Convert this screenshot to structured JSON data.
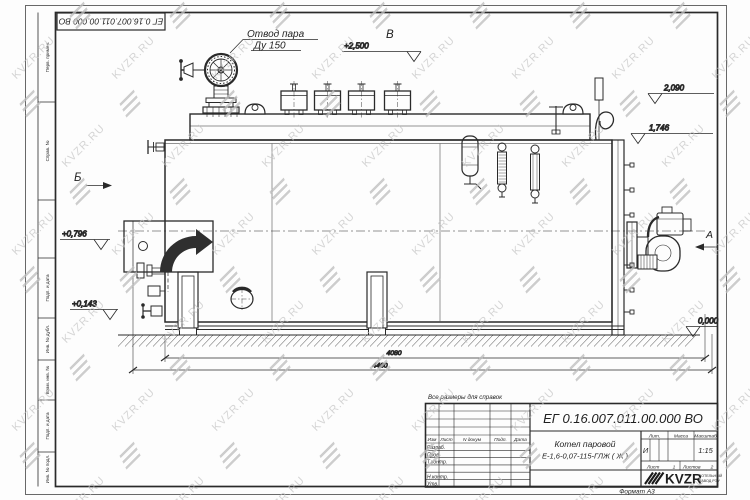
{
  "watermark": {
    "text": "KVZR.RU"
  },
  "margins": [
    "Перв. примен.",
    "Справ. №",
    "Подп. и дата",
    "Инв. № дубл.",
    "Взам. инв. №",
    "Подп. и дата",
    "Инв. № подл."
  ],
  "drawing": {
    "stamp": "ЕГ 0.16.007.011.00.000  ВО",
    "callout1": "Отвод пара",
    "callout2": "Ду 150",
    "views": {
      "b": "Б",
      "v": "В",
      "a": "А"
    },
    "elev": {
      "e1": "+2,500",
      "e2": "2,090",
      "e3": "1,746",
      "e4": "+0,796",
      "e5": "+0,143",
      "e6": "0,000"
    },
    "dims": {
      "d1": "4080",
      "d2": "4460"
    }
  },
  "title_block": {
    "note": "Все размеры для справок",
    "doc_number": "ЕГ 0.16.007.011.00.000  ВО",
    "name1": "Котел паровой",
    "name2": "Е-1,6-0,07-115-ГЛЖ ( Ж )",
    "cols": {
      "izm": "Изм",
      "list": "Лист",
      "ndok": "N докум",
      "podp": "Подп.",
      "data": "Дата"
    },
    "rows": {
      "r1": "Разраб.",
      "r2": "Пров.",
      "r3": "Т.контр.",
      "r4": "Н.контр.",
      "r5": "Утв."
    },
    "lit": {
      "label": "Лит.",
      "value": "И"
    },
    "massa": {
      "label": "Масса",
      "value": ""
    },
    "scale": {
      "label": "Масштаб",
      "value": "1:15"
    },
    "sheet": {
      "label": "Лист",
      "value": "1"
    },
    "sheets": {
      "label": "Листов",
      "value": "2"
    },
    "brand": {
      "logo": "KVZR",
      "line1": "КОТЕЛЬНЫЙ",
      "line2": "ЗАВОД РЭУ"
    },
    "format": "Формат А3"
  }
}
